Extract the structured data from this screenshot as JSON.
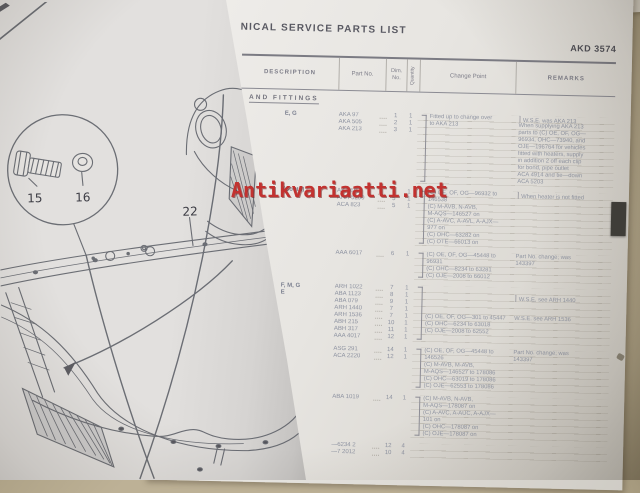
{
  "watermark": {
    "text": "Antikvariaatti.net",
    "color": "#c23230"
  },
  "book": {
    "left_page": {
      "kind": "exploded-line-drawing-of-bonnet-underside",
      "callouts": {
        "bolt": "15",
        "washer": "16",
        "panel": "22"
      }
    },
    "right_page": {
      "header": {
        "title": "NICAL SERVICE PARTS LIST",
        "code": "AKD 3574"
      },
      "table": {
        "section": "AND FITTINGS",
        "columns": [
          "DESCRIPTION",
          "Part No.",
          "Dim.\nNo.",
          "Quantity",
          "Change Point",
          "REMARKS"
        ],
        "tab_color": "#403f3b",
        "blocks": [
          {
            "g": "E, G",
            "parts": [
              [
                "AKA 97",
                "1",
                "1"
              ],
              [
                "AKA 505",
                "2",
                "1"
              ],
              [
                "AKA 213",
                "3",
                "1"
              ]
            ],
            "chgBrace": true,
            "chg": [
              "Fitted up to change over",
              "to AKA 213"
            ],
            "rem": [
              "] W.S.E. was AKA 213",
              "When supplying AKA 213",
              "parts to (C) OE, OF, OG—",
              "96934, OHC—73940, and",
              "OJE—196764 for vehicles",
              "fitted with heaters, supply",
              "in addition 2 off each clip",
              "for bond, pipe outlet",
              "ACA 4914 and tie—down",
              "ACA 5203"
            ]
          },
          {
            "g": "(Contd)",
            "parts": [
              [
                "AKA 602",
                "4",
                "1"
              ],
              [
                "AHH 5250",
                "5",
                "1"
              ],
              [
                "ACA 823",
                "5",
                "1"
              ]
            ],
            "chgBrace": true,
            "chg": [
              "(C) OE, OF, OG—96932 to",
              "146538",
              "(C) M-AVB, N-AVB,",
              "M-AQS—146527 on",
              "(C) A-AVC, A-AVL, A-AJX—",
              "977 on",
              "(C) OHC—63282 on",
              "(C) OTE—66013 on"
            ],
            "rem": [
              "] When heater is not fitted"
            ]
          },
          {
            "g": "",
            "parts": [
              [
                "AAA 6017",
                "6",
                "1"
              ]
            ],
            "chgBrace": true,
            "chg": [
              "(C) OE, OF, OG—45448 to",
              "96931",
              "(C) OHC—8234 to 63281",
              "(C) OJE—2008 to 66012"
            ],
            "rem": [
              "Part No. change; was",
              "143397"
            ]
          },
          {
            "g": "F, M, G\nE",
            "parts": [
              [
                "ARH 1022",
                "7",
                "1"
              ],
              [
                "ABA 1123",
                "8",
                "1"
              ],
              [
                "ABA 079",
                "9",
                "1"
              ],
              [
                "ARH 1440",
                "7",
                "1"
              ],
              [
                "ARH 1536",
                "7",
                "1"
              ],
              [
                "ABH 215",
                "10",
                "1"
              ],
              [
                "ABH 317",
                "11",
                "1"
              ],
              [
                "AAA 4017",
                "12",
                "1"
              ]
            ],
            "chgBrace": true,
            "chg": [
              "",
              "",
              "",
              "",
              "(C) OE, OF, OG—301 to 45447",
              "(C) OHC—6234 to 63018",
              "(C) OJE—2008 to 62552"
            ],
            "rem": [
              "",
              "] W.S.E. see ARH 1440",
              "",
              "",
              "W.S.E. see ARH 1536"
            ]
          },
          {
            "g": "",
            "parts": [
              [
                "ASG 291",
                "14",
                "1"
              ],
              [
                "ACA 2220",
                "12",
                "1"
              ]
            ],
            "chgBrace": true,
            "chg": [
              "(C) OE, OF, OG—45448 to",
              "146526",
              "(C) M-AVB, M-AVB,",
              "M-AQS—146527 to 178086",
              "(C) OHC—63019 to 178086",
              "(C) OJE—62553 to 178086"
            ],
            "rem": [
              "Part No. change; was",
              "143397"
            ]
          },
          {
            "g": "",
            "parts": [
              [
                "ABA 1019",
                "14",
                "1"
              ]
            ],
            "chgBrace": true,
            "chg": [
              "(C) M-AVB, N-AVB,",
              "M-AQS—178087 on",
              "(C) A-AVC, A-AUC, A-AJX—",
              "101 on",
              "(C) OHC—178087 on",
              "(C) OJE—178087 on"
            ],
            "rem": []
          },
          {
            "g": "",
            "parts": [
              [
                "—6234 2",
                "12",
                "4"
              ],
              [
                "—7 2012",
                "10",
                "4"
              ]
            ],
            "chg": [],
            "rem": []
          }
        ]
      }
    }
  }
}
